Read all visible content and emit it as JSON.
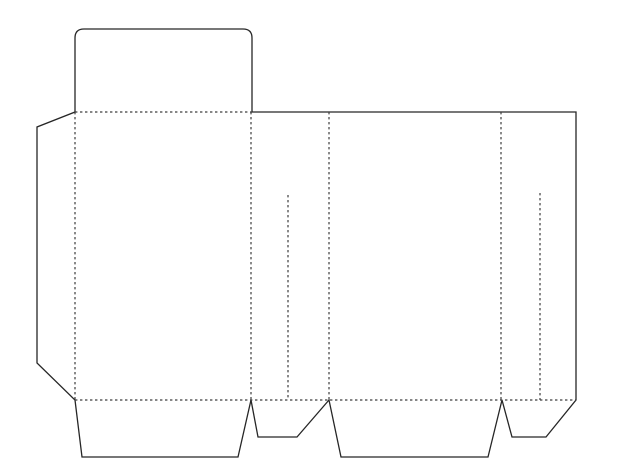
{
  "canvas": {
    "width": 620,
    "height": 474,
    "background": "#ffffff"
  },
  "style": {
    "cut_color": "#262626",
    "cut_width": 1.3,
    "fold_color": "#3d3d3d",
    "fold_width": 1.2,
    "fold_dash": "2.4 2.6"
  },
  "dieline": {
    "kind": "box-packaging-dieline",
    "description": "Flat box net: solid lines are cut edges, dashed lines are fold creases",
    "cut_paths": [
      {
        "name": "cut-outline",
        "d": "M75,112 L75,38 Q75,29 84,29 L243,29 Q252,29 252,38 L252,112 L576,112 L576,400 L546,437 L512,437 L502,400 L488,457 L341,457 L329,400 L297,437 L258,437 L251,400 L238,457 L82,457 L75,400 L37,363 L37,127 Z"
      }
    ],
    "fold_lines": [
      {
        "name": "fold-lid-tuck-flap",
        "x1": 75,
        "y1": 112,
        "x2": 252,
        "y2": 112
      },
      {
        "name": "fold-glue-flap",
        "x1": 75,
        "y1": 112,
        "x2": 75,
        "y2": 400
      },
      {
        "name": "fold-panel1-panel2",
        "x1": 251,
        "y1": 112,
        "x2": 251,
        "y2": 400
      },
      {
        "name": "fold-panel2-panel3",
        "x1": 329,
        "y1": 112,
        "x2": 329,
        "y2": 400
      },
      {
        "name": "fold-panel3-panel4",
        "x1": 501,
        "y1": 112,
        "x2": 501,
        "y2": 400
      },
      {
        "name": "fold-bottom-flaps",
        "x1": 75,
        "y1": 400,
        "x2": 576,
        "y2": 400
      },
      {
        "name": "crease-side-panel-left",
        "x1": 288,
        "y1": 195,
        "x2": 288,
        "y2": 400
      },
      {
        "name": "crease-side-panel-right",
        "x1": 540,
        "y1": 193,
        "x2": 540,
        "y2": 400
      }
    ]
  }
}
